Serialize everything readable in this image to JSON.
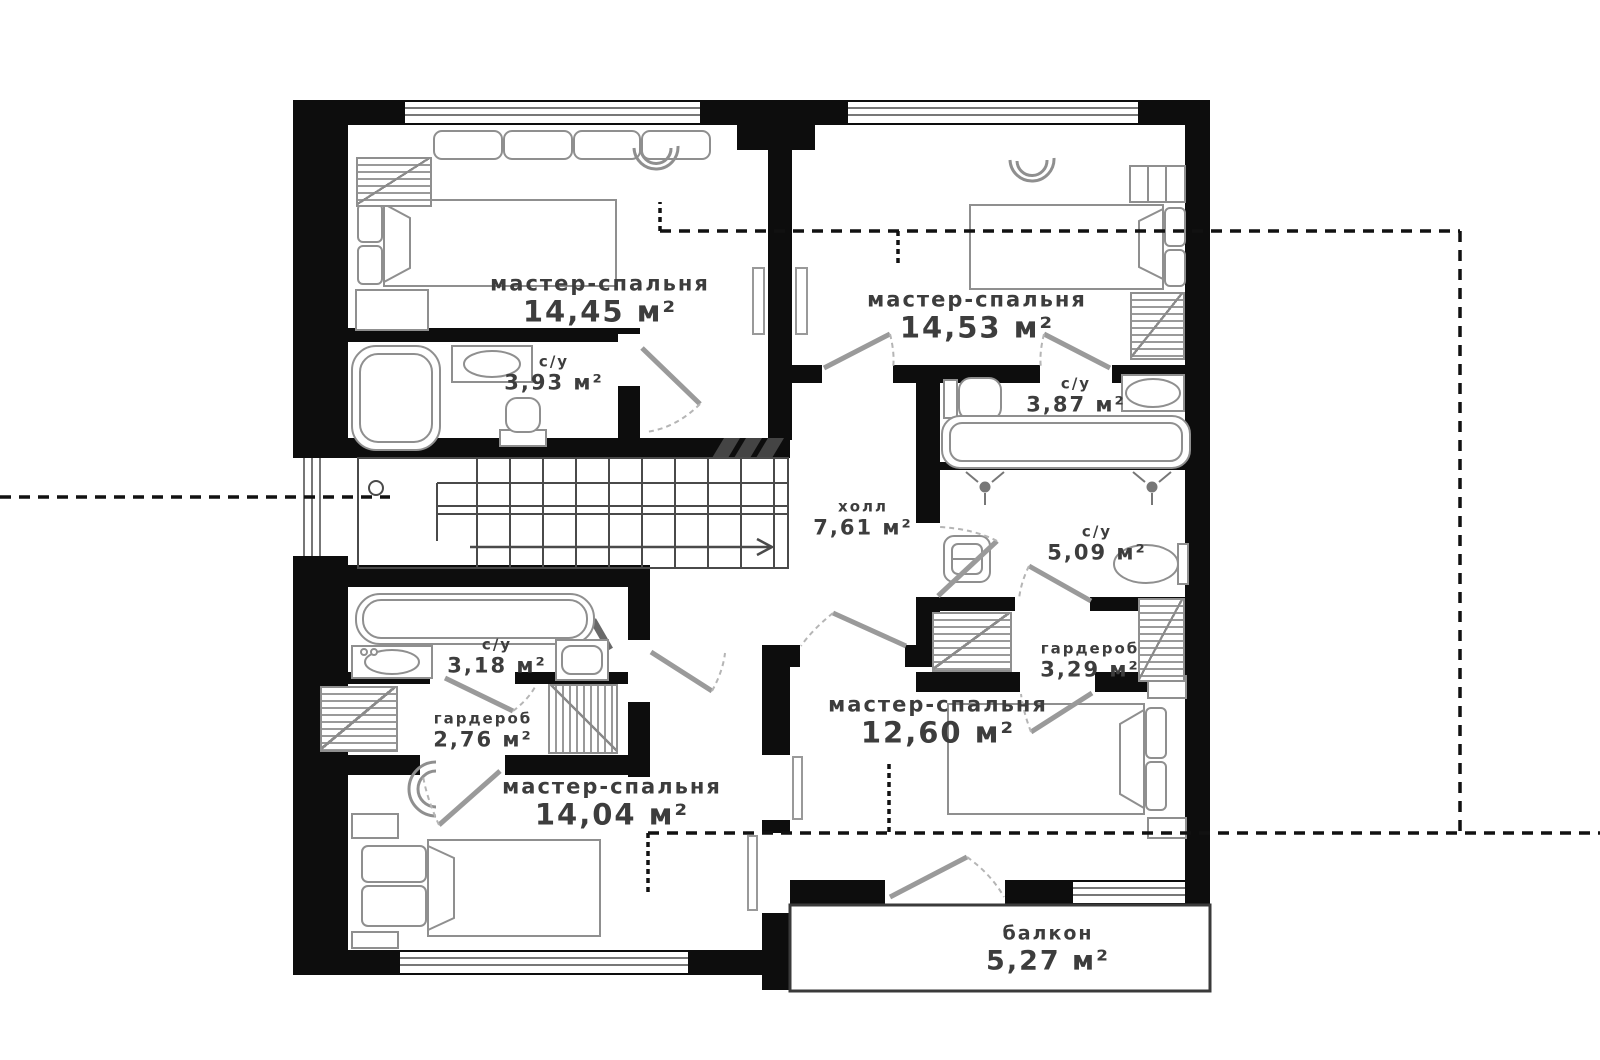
{
  "plan": {
    "kind": "floor-plan",
    "language": "ru",
    "colors": {
      "wall": "#0d0d0d",
      "furniture_outline": "#8f8f8f",
      "label_text": "#3d3d3d",
      "background": "#ffffff",
      "section_line": "#111111"
    },
    "icons": {
      "stairs_direction": "stairs-up-arrow-icon",
      "shower": "shower-head-icon",
      "bath": "bathtub-icon",
      "toilet": "toilet-icon",
      "sink": "sink-icon",
      "bed": "double-bed-icon",
      "wardrobe": "wardrobe-hatch-icon",
      "lamp": "ceiling-lamp-icon",
      "washer": "washing-machine-icon"
    },
    "rooms": [
      {
        "id": "master-bedroom-1",
        "name": "мастер-спальня",
        "area": "14,45 м²"
      },
      {
        "id": "bathroom-1",
        "name": "с/у",
        "area": "3,93 м²"
      },
      {
        "id": "master-bedroom-2",
        "name": "мастер-спальня",
        "area": "14,53 м²"
      },
      {
        "id": "bathroom-2",
        "name": "с/у",
        "area": "3,87 м²"
      },
      {
        "id": "hall",
        "name": "холл",
        "area": "7,61 м²"
      },
      {
        "id": "bathroom-3",
        "name": "с/у",
        "area": "5,09 м²"
      },
      {
        "id": "wardrobe-1",
        "name": "гардероб",
        "area": "3,29 м²"
      },
      {
        "id": "bathroom-4",
        "name": "с/у",
        "area": "3,18 м²"
      },
      {
        "id": "wardrobe-2",
        "name": "гардероб",
        "area": "2,76 м²"
      },
      {
        "id": "master-bedroom-3",
        "name": "мастер-спальня",
        "area": "14,04 м²"
      },
      {
        "id": "master-bedroom-4",
        "name": "мастер-спальня",
        "area": "12,60 м²"
      },
      {
        "id": "balcony",
        "name": "балкон",
        "area": "5,27 м²"
      }
    ]
  }
}
